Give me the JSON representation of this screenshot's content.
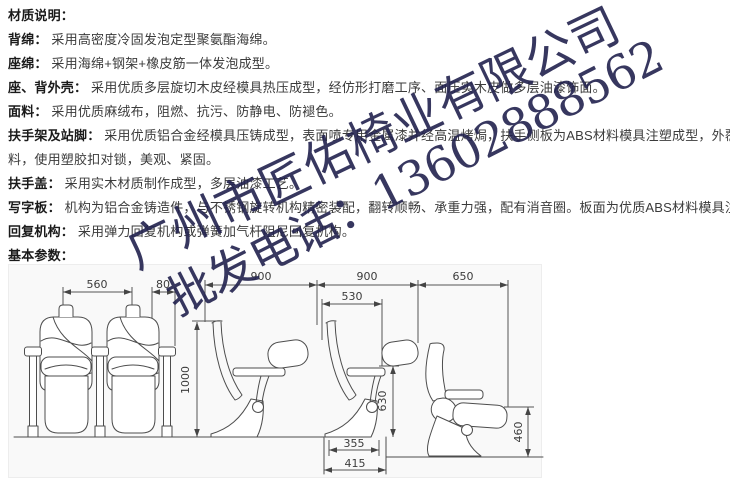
{
  "materials": {
    "lines": [
      {
        "label": "材质说明：",
        "text": ""
      },
      {
        "label": "背绵：",
        "text": "采用高密度冷固发泡定型聚氨酯海绵。"
      },
      {
        "label": "座绵：",
        "text": "采用海绵+钢架+橡皮筋一体发泡成型。"
      },
      {
        "label": "座、背外壳：",
        "text": "采用优质多层旋切木皮经模具热压成型，经仿形打磨工序、面压实木皮做多层油漆饰面。"
      },
      {
        "label": "面料：",
        "text": "采用优质麻绒布，阻燃、抗污、防静电、防褪色。"
      },
      {
        "label": "扶手架及站脚：",
        "text": "采用优质铝合金经模具压铸成型，表面喷专用金属漆并经高温烤焗，扶手侧板为ABS材料模具注塑成型，外覆优质面"
      },
      {
        "label": "",
        "text": "料，使用塑胶扣对锁，美观、紧固。"
      },
      {
        "label": "扶手盖：",
        "text": "采用实木材质制作成型，多层油漆工艺。"
      },
      {
        "label": "写字板：",
        "text": "机构为铝合金铸造件，与不锈钢旋转机构精密装配，翻转顺畅、承重力强，配有消音圈。板面为优质ABS材料模具注塑成型。"
      },
      {
        "label": "回复机构：",
        "text": "采用弹力回复机构或弹簧加气杆阻尼回复机构。"
      },
      {
        "label": "基本参数：",
        "text": ""
      }
    ]
  },
  "watermark": {
    "line1": "广州市匠佑椅业有限公司",
    "line2": "批发电话：13602888562",
    "color": "#22224e"
  },
  "drawing": {
    "dims": {
      "seat_center_spacing": "560",
      "armrest_width": "80",
      "row_pitch_1": "900",
      "row_pitch_2": "900",
      "folded_depth": "650",
      "tablet_span": "530",
      "overall_height": "1000",
      "tablet_height": "630",
      "foot_width": "355",
      "base_width": "415",
      "folded_seat_height": "460"
    }
  }
}
